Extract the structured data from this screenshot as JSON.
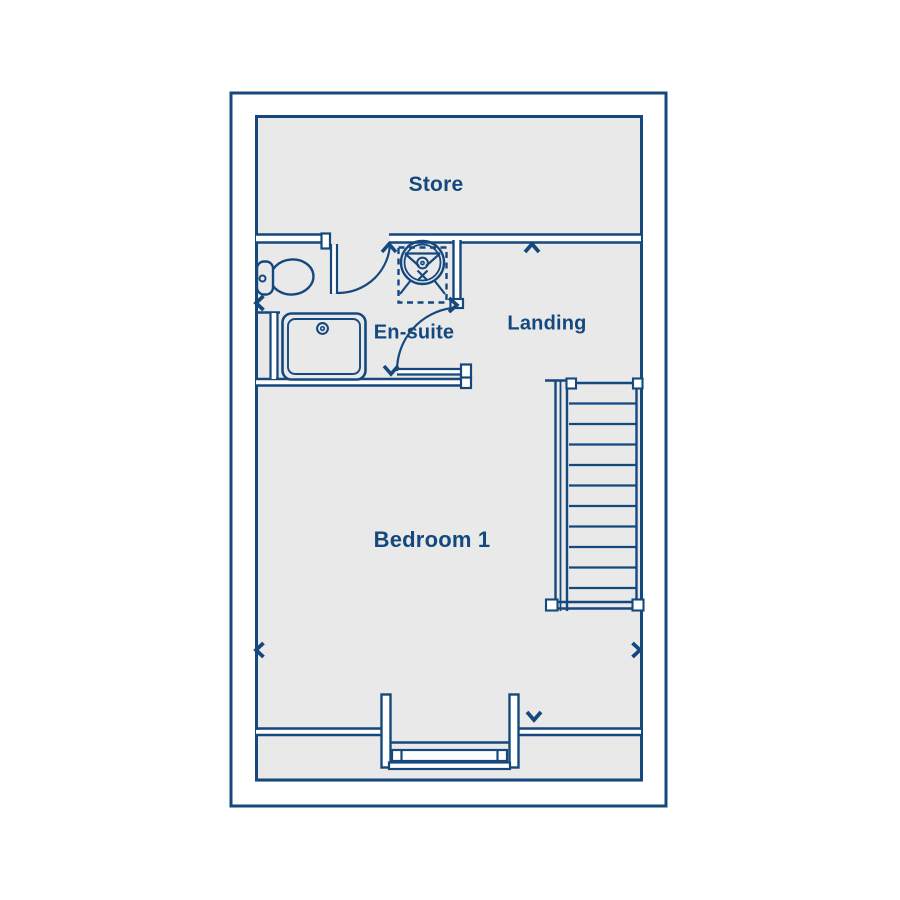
{
  "floorplan": {
    "rooms": [
      {
        "id": "store",
        "label": "Store"
      },
      {
        "id": "ensuite",
        "label": "En-suite"
      },
      {
        "id": "landing",
        "label": "Landing"
      },
      {
        "id": "bedroom1",
        "label": "Bedroom 1"
      }
    ],
    "colors": {
      "line": "#15497e",
      "text": "#14497d",
      "floor": "#e9e9ea",
      "background": "#ffffff"
    },
    "symbols": [
      "toilet-icon",
      "shower-enclosure-icon",
      "shower-tray-icon",
      "staircase-icon",
      "window-icon",
      "door-swing-icon",
      "chevron-arrow-icon"
    ]
  }
}
